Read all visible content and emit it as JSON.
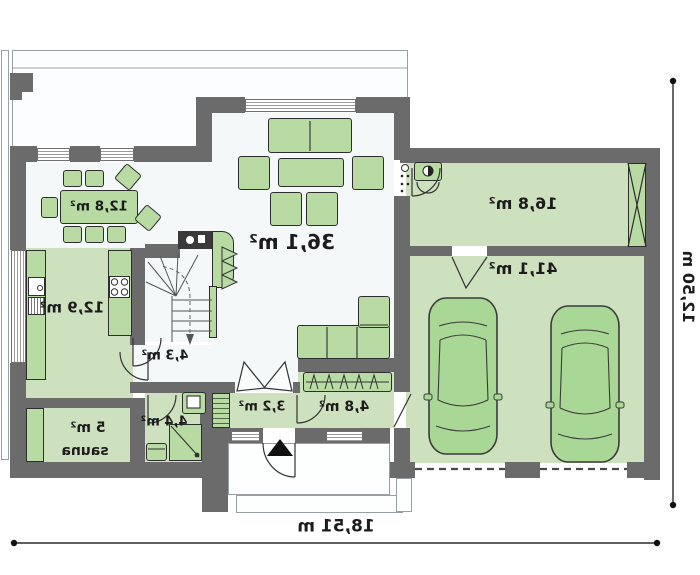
{
  "rooms": {
    "dining": {
      "area": "12,8 m²"
    },
    "living": {
      "area": "36,1 m²"
    },
    "kitchen": {
      "area": "12,9 m²"
    },
    "utility": {
      "area": "16,8 m²"
    },
    "garage": {
      "area": "41,1 m²"
    },
    "hall": {
      "area": "4,3 m²"
    },
    "sauna": {
      "area": "5 m²",
      "name": "sauna"
    },
    "bathroom": {
      "area": "4,4 m²"
    },
    "entry": {
      "area": "3,2 m²"
    },
    "corridor": {
      "area": "4,8 m²"
    }
  },
  "dimensions": {
    "width": "18,51 m",
    "depth": "12,50 m"
  },
  "colors": {
    "wall": "#6b6b6b",
    "floorLight": "#f4f8f9",
    "floorGreen": "#cde1bf",
    "furn": "#b7dba2",
    "carFill": "#a9d795",
    "line": "#2e2e2e",
    "text": "#1c1c1c"
  }
}
